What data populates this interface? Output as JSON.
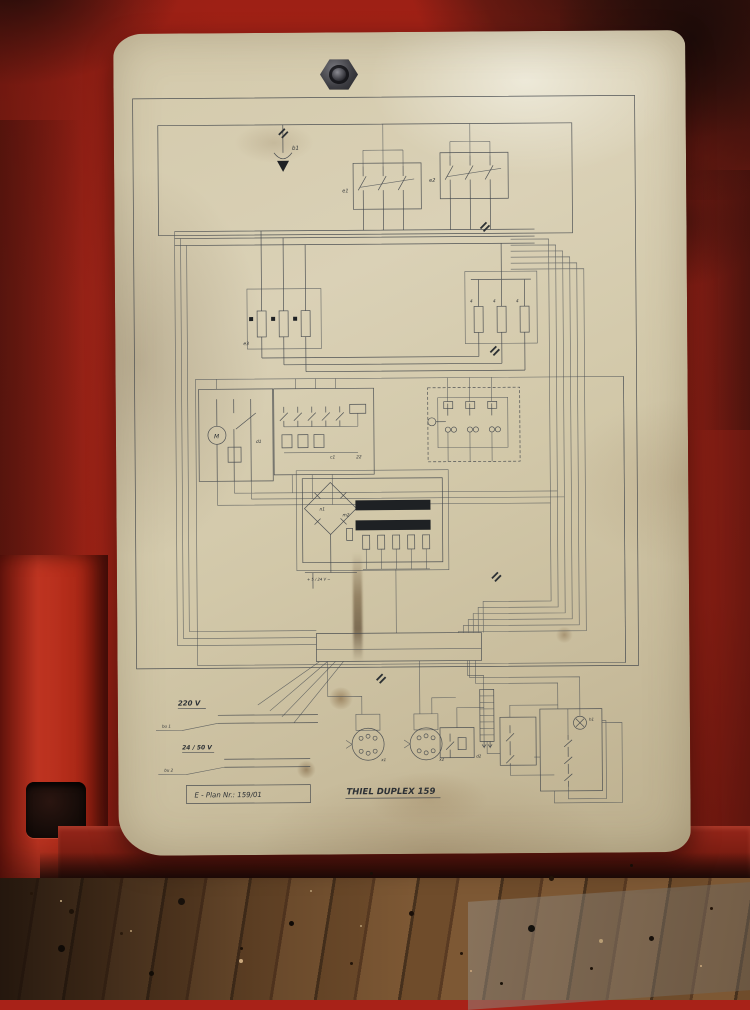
{
  "titleblock": {
    "plan_label": "E - Plan  Nr.: 159/01",
    "machine_title": "THIEL DUPLEX 159"
  },
  "schematic": {
    "ground_label": "b1",
    "switch_left_label": "e1",
    "switch_right_label": "e2",
    "phases_top": [
      "R",
      "S",
      "T"
    ],
    "phases_bottom": [
      "U",
      "V",
      "W"
    ],
    "fuse_left_group_label": "e3",
    "fuse_right_labels": [
      "e1",
      "e2"
    ],
    "fuse_rating_label": "4",
    "motor_letter": "M",
    "motor_block_label": "d1",
    "contact_block_label": "c1",
    "contact_block_terminal": "22",
    "rectifier_label": "n1",
    "transformer_label": "m2",
    "transformer_tap_labels": [
      "0",
      "24v",
      "50v",
      "110v",
      "220v",
      "0"
    ],
    "dc_output_label": "+ 5 / 24 V −",
    "strip_220": {
      "label": "220 V",
      "ref": "bu 1",
      "terminal_count": 18
    },
    "strip_24_50": {
      "label": "24 / 50 V",
      "ref": "bu 2",
      "terminal_count": 16
    },
    "main_strip": {
      "cell_count": 24
    },
    "connector_left_label": "x1",
    "connector_right_label": "x2",
    "aux_relay_label": "d2",
    "lamp_label": "h1",
    "control_rows": [
      {
        "label": "KONTR.",
        "ref": ""
      },
      {
        "label": "EIN",
        "ref": "b2"
      },
      {
        "label": "AUS",
        "ref": "b3"
      },
      {
        "label": "STÖRUNG",
        "ref": "b4"
      }
    ]
  }
}
